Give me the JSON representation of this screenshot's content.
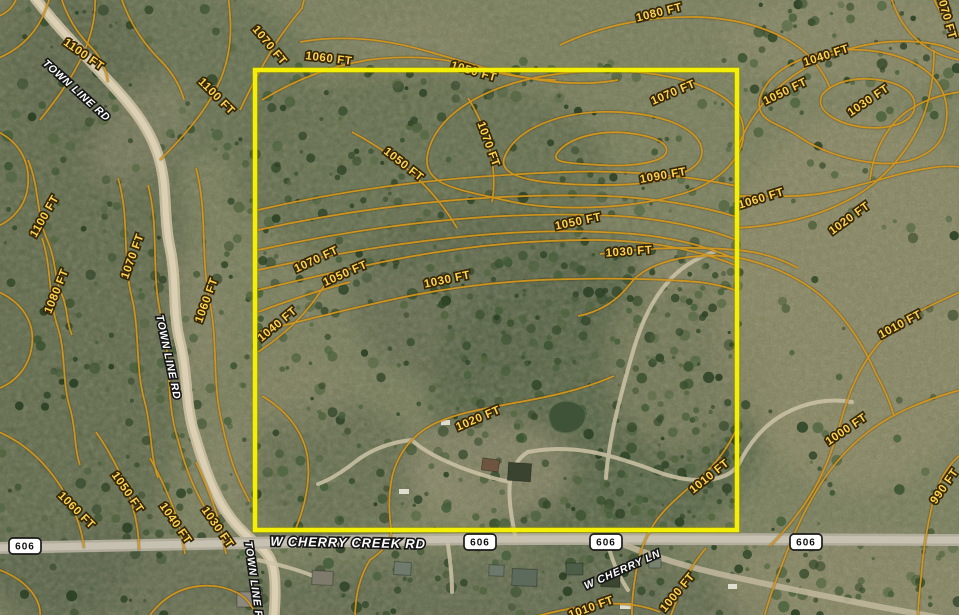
{
  "map": {
    "parcel": {
      "stroke_color": "#f4ef06",
      "x": 255,
      "y": 70,
      "width": 482,
      "height": 460
    },
    "contour_line_color": "#d4971b",
    "contour_labels": [
      {
        "text": "1100 FT",
        "x": 84,
        "y": 54,
        "rot": 35
      },
      {
        "text": "1100 FT",
        "x": 217,
        "y": 96,
        "rot": 45
      },
      {
        "text": "1070 FT",
        "x": 270,
        "y": 45,
        "rot": 50
      },
      {
        "text": "1060 FT",
        "x": 329,
        "y": 58,
        "rot": 7
      },
      {
        "text": "1050 FT",
        "x": 474,
        "y": 71,
        "rot": 16
      },
      {
        "text": "1080 FT",
        "x": 659,
        "y": 12,
        "rot": -14
      },
      {
        "text": "1070 FT",
        "x": 673,
        "y": 92,
        "rot": -23
      },
      {
        "text": "1040 FT",
        "x": 826,
        "y": 55,
        "rot": -18
      },
      {
        "text": "1050 FT",
        "x": 785,
        "y": 91,
        "rot": -26
      },
      {
        "text": "1030 FT",
        "x": 868,
        "y": 100,
        "rot": -34
      },
      {
        "text": "1070 FT",
        "x": 947,
        "y": 16,
        "rot": 74
      },
      {
        "text": "1070 FT",
        "x": 489,
        "y": 144,
        "rot": 70
      },
      {
        "text": "1050 FT",
        "x": 404,
        "y": 164,
        "rot": 38
      },
      {
        "text": "1090 FT",
        "x": 663,
        "y": 175,
        "rot": -10
      },
      {
        "text": "1060 FT",
        "x": 761,
        "y": 198,
        "rot": -17
      },
      {
        "text": "1050 FT",
        "x": 578,
        "y": 221,
        "rot": -12
      },
      {
        "text": "1030 FT",
        "x": 629,
        "y": 251,
        "rot": -4
      },
      {
        "text": "1020 FT",
        "x": 849,
        "y": 218,
        "rot": -36
      },
      {
        "text": "1070 FT",
        "x": 316,
        "y": 259,
        "rot": -25
      },
      {
        "text": "1050 FT",
        "x": 345,
        "y": 273,
        "rot": -24
      },
      {
        "text": "1030 FT",
        "x": 447,
        "y": 279,
        "rot": -12
      },
      {
        "text": "1040 FT",
        "x": 277,
        "y": 324,
        "rot": -40
      },
      {
        "text": "1100 FT",
        "x": 44,
        "y": 216,
        "rot": -60
      },
      {
        "text": "1070 FT",
        "x": 132,
        "y": 256,
        "rot": -70
      },
      {
        "text": "1080 FT",
        "x": 56,
        "y": 291,
        "rot": -68
      },
      {
        "text": "1060 FT",
        "x": 206,
        "y": 300,
        "rot": -70
      },
      {
        "text": "1010 FT",
        "x": 900,
        "y": 324,
        "rot": -28
      },
      {
        "text": "1020 FT",
        "x": 478,
        "y": 418,
        "rot": -23
      },
      {
        "text": "1000 FT",
        "x": 846,
        "y": 429,
        "rot": -34
      },
      {
        "text": "1010 FT",
        "x": 709,
        "y": 476,
        "rot": -39
      },
      {
        "text": "990 FT",
        "x": 944,
        "y": 486,
        "rot": -55
      },
      {
        "text": "1050 FT",
        "x": 128,
        "y": 492,
        "rot": 55
      },
      {
        "text": "1060 FT",
        "x": 77,
        "y": 510,
        "rot": 45
      },
      {
        "text": "1040 FT",
        "x": 176,
        "y": 523,
        "rot": 55
      },
      {
        "text": "1030 FT",
        "x": 218,
        "y": 527,
        "rot": 55
      },
      {
        "text": "1000 FT",
        "x": 677,
        "y": 592,
        "rot": -50
      },
      {
        "text": "1010 FT",
        "x": 591,
        "y": 607,
        "rot": -20
      }
    ],
    "road_labels": [
      {
        "text": "TOWN LINE RD",
        "x": 77,
        "y": 90,
        "rot": 42,
        "size": 10.5
      },
      {
        "text": "TOWN LINE RD",
        "x": 169,
        "y": 357,
        "rot": 78,
        "size": 10.5
      },
      {
        "text": "TOWN LINE RD",
        "x": 255,
        "y": 584,
        "rot": 82,
        "size": 10.5
      },
      {
        "text": "W CHERRY CREEK RD",
        "x": 348,
        "y": 543,
        "rot": 1,
        "size": 13
      },
      {
        "text": "W CHERRY LN",
        "x": 622,
        "y": 569,
        "rot": -24,
        "size": 10.5
      }
    ],
    "route_shields": [
      {
        "text": "606",
        "x": 25,
        "y": 546
      },
      {
        "text": "606",
        "x": 480,
        "y": 542
      },
      {
        "text": "606",
        "x": 606,
        "y": 542
      },
      {
        "text": "606",
        "x": 806,
        "y": 542
      }
    ]
  }
}
